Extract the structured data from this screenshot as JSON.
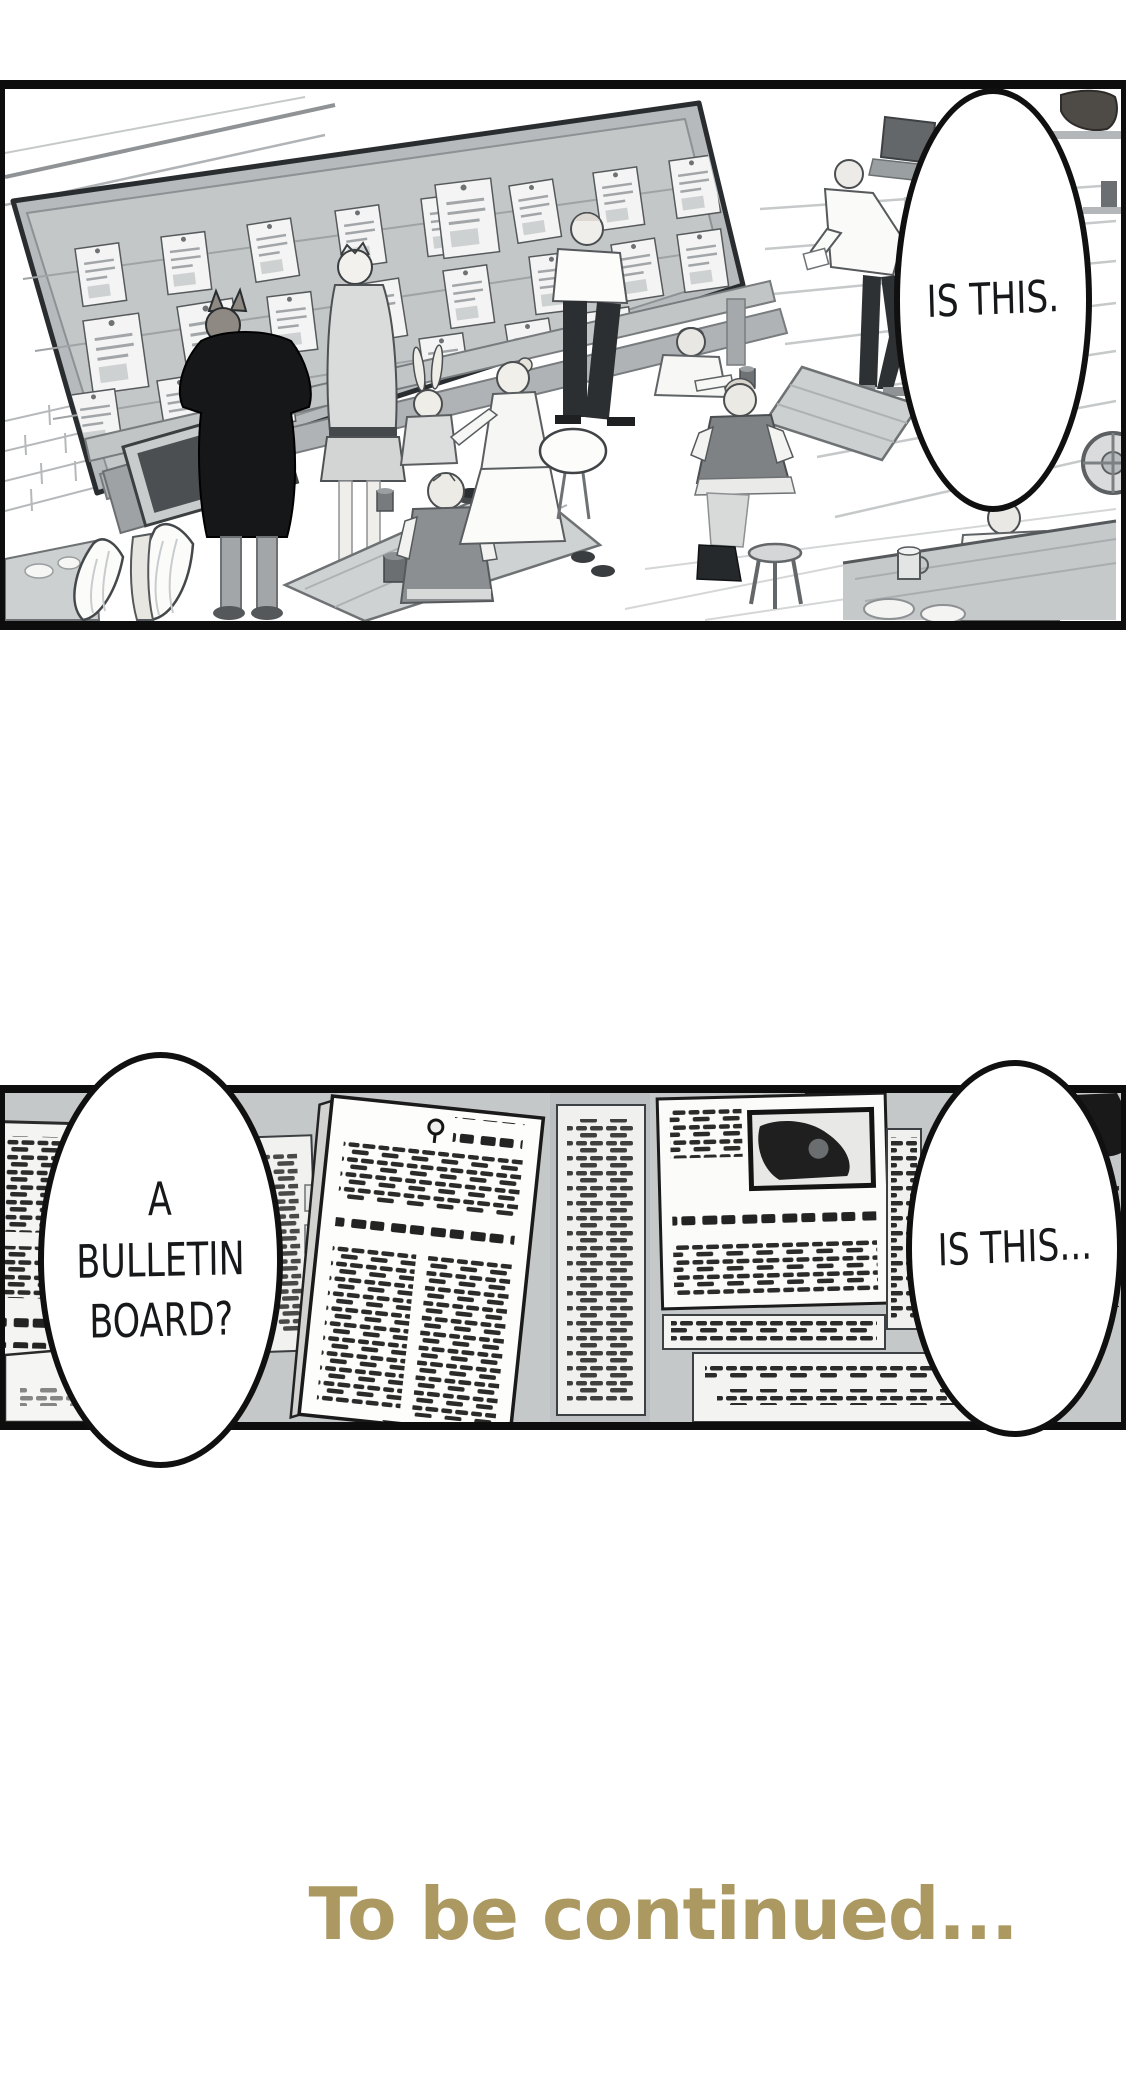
{
  "comic": {
    "panel_top": {
      "bubble_is_this": "IS THIS."
    },
    "panel_middle": {
      "bubble_bulletin_line1": "A BULLETIN",
      "bubble_bulletin_line2": "BOARD?",
      "bubble_is_this": "IS THIS..."
    },
    "footer_to_be_continued": "To be continued...",
    "colors": {
      "footer_text": "#ac9962",
      "panel_border": "#0d0d0d",
      "bubble_fill": "#ffffff",
      "bubble_stroke": "#101010",
      "board_gray": "#c4c7c8",
      "paper_white": "#f3f4f3",
      "ink_black": "#1a1a1a"
    }
  }
}
